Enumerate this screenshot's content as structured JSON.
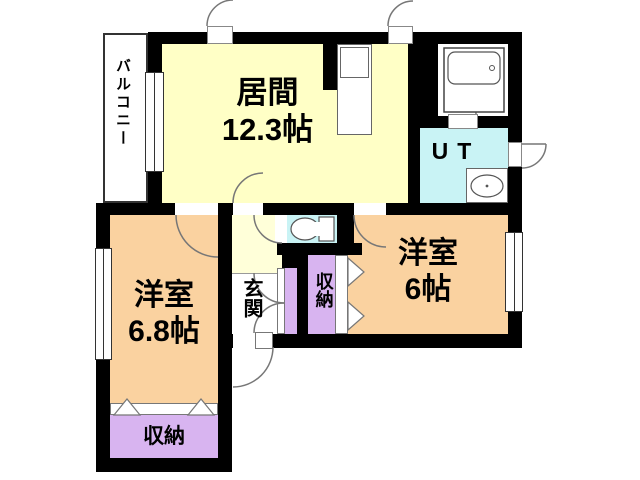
{
  "floorplan": {
    "rooms": {
      "living": {
        "name": "居間",
        "area": "12.3帖"
      },
      "balcony": {
        "name": "バルコニー"
      },
      "utility": {
        "name": "UT"
      },
      "bedroom_right": {
        "name": "洋室",
        "area": "6帖"
      },
      "bedroom_left": {
        "name": "洋室",
        "area": "6.8帖"
      },
      "entrance": {
        "name": "玄関"
      },
      "closet_hall": {
        "name": "収納"
      },
      "closet_bedroom": {
        "name": "収納"
      }
    },
    "colors": {
      "wall": "#000000",
      "living_yellow": "#FFFFC6",
      "hall_yellow": "#FFFFD9",
      "bedroom_orange": "#FAD2A0",
      "wet_cyan": "#C9F3F5",
      "closet_purple": "#D8B4F0"
    }
  }
}
